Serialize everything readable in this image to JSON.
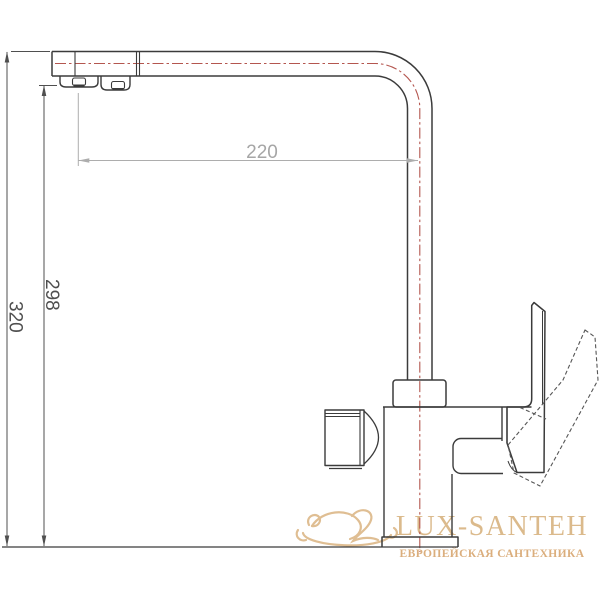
{
  "drawing": {
    "title": "kitchen-faucet-technical-drawing",
    "dim_reach": "220",
    "dim_height_spout": "298",
    "dim_height_total": "320",
    "colors": {
      "outline": "#3b3b3b",
      "centerline_red": "#b4564f",
      "dim_dark": "#4f4f4f",
      "dim_gray": "#a6a6a6"
    }
  },
  "watermark": {
    "brand": "LUX-SANTEH",
    "tagline": "ЕВРОПЕЙСКАЯ САНТЕХНИКА",
    "gold_light": "#d9b583",
    "gold_deep": "#d8a872"
  }
}
